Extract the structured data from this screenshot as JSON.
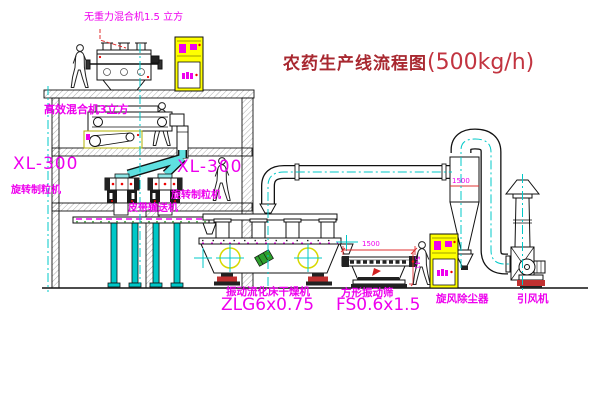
{
  "diagram": {
    "title": "农药生产线流程图",
    "title_capacity": "(500kg/h)"
  },
  "equipment_labels": {
    "gravity_free_mixer": "无重力混合机1.5 立方",
    "high_efficiency_mixer": "高效混合机3立方",
    "granulator_left_model": "XL-300",
    "granulator_left_name": "旋转制粒机",
    "granulator_right_model": "XL-300",
    "granulator_right_name": "旋转制粒机",
    "belt_conveyor": "皮带输送机",
    "fluid_bed_dryer_name": "振动流化床干燥机",
    "fluid_bed_dryer_model": "ZLG6x0.75",
    "vibrating_screen_name": "方形振动筛",
    "vibrating_screen_model": "FS0.6x1.5",
    "cyclone_dust_collector": "旋风除尘器",
    "induced_draft_fan": "引风机"
  },
  "dimension_labels": {
    "cyclone_height": "1500",
    "screen_length": "1500",
    "screen_height": "541"
  },
  "colors": {
    "label_magenta": "#ee00ee",
    "title_red": "#a82830",
    "centerline_cyan": "#00c8c8",
    "cabinet_yellow": "#ffff00",
    "dimension_red": "#e03030",
    "line_black": "#111111"
  }
}
